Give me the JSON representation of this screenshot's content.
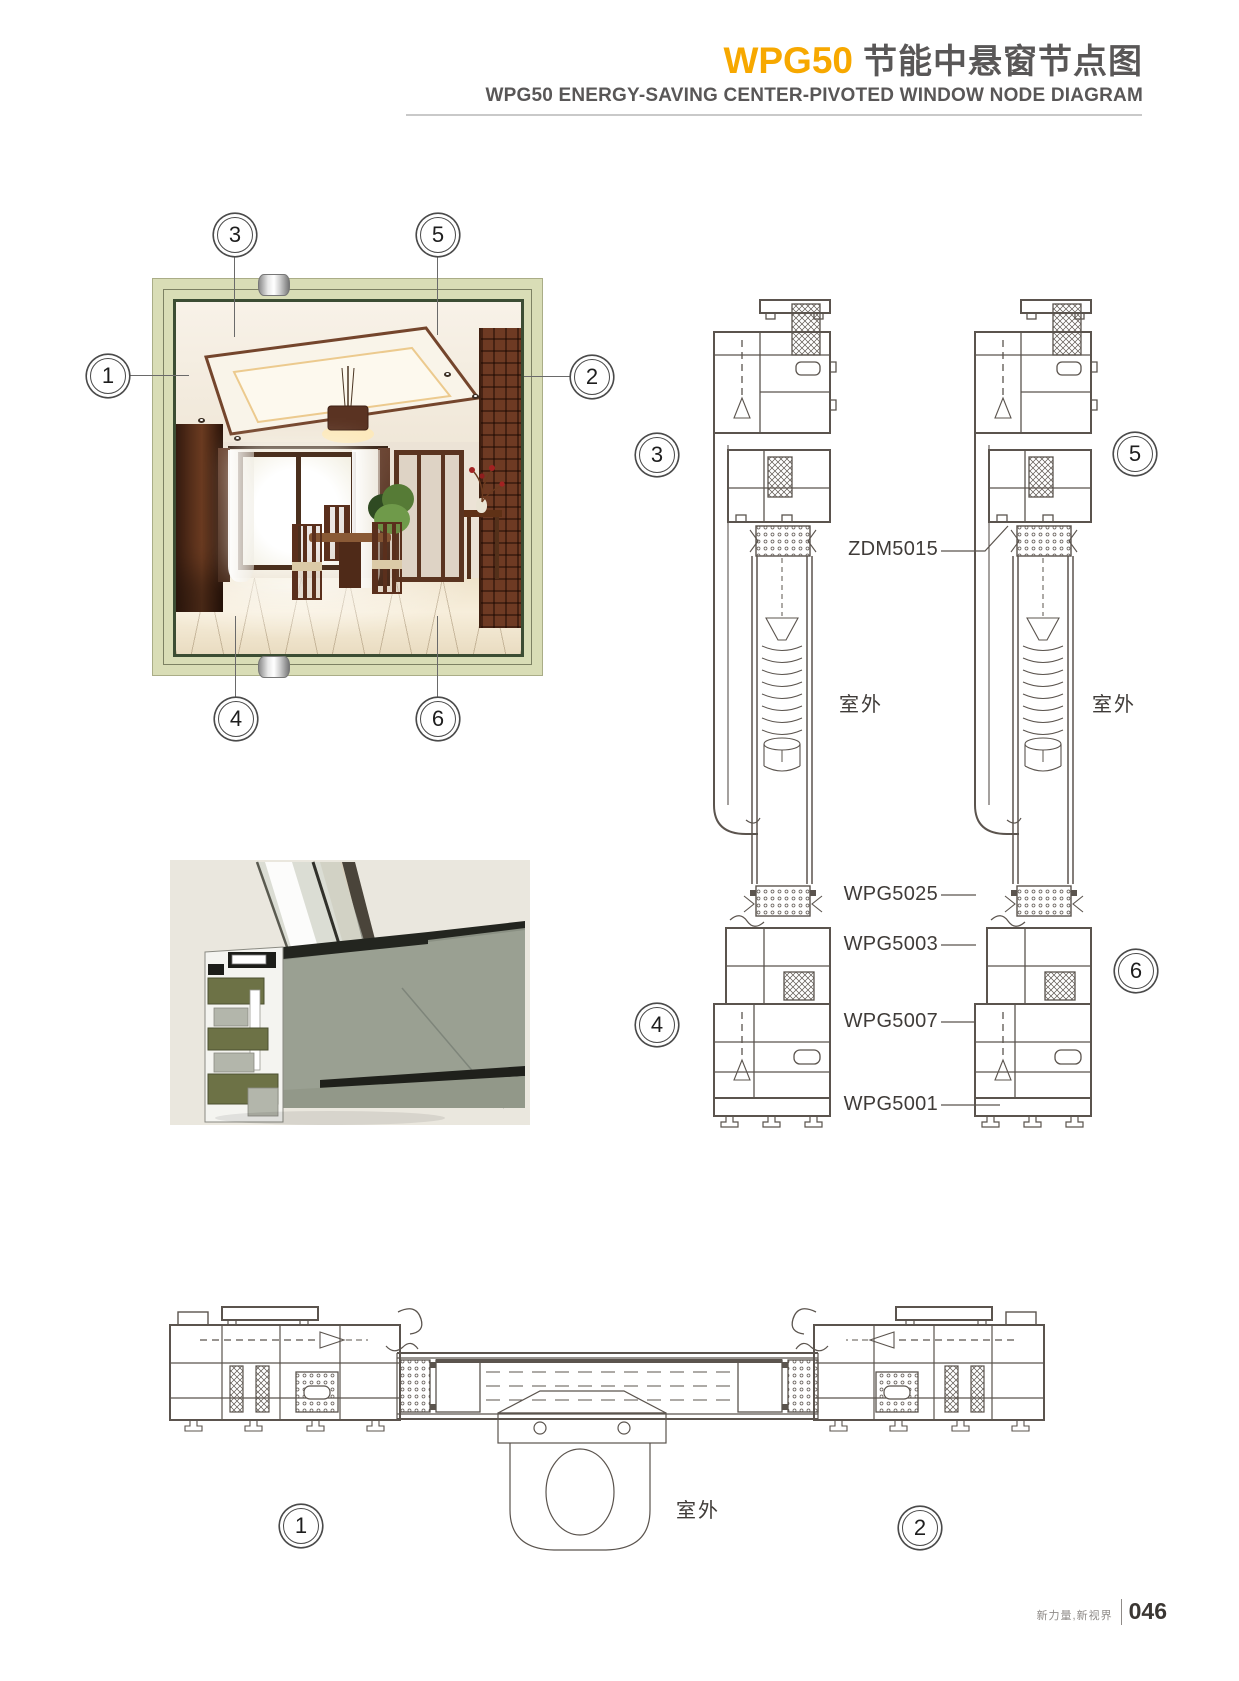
{
  "header": {
    "brand": "WPG50",
    "title_zh": "节能中悬窗节点图",
    "subtitle_en": "WPG50 ENERGY-SAVING CENTER-PIVOTED WINDOW NODE DIAGRAM"
  },
  "callouts": {
    "n1": "1",
    "n2": "2",
    "n3": "3",
    "n4": "4",
    "n5": "5",
    "n6": "6"
  },
  "diagram": {
    "outdoor_label": "室外",
    "part_labels": {
      "zdm5015": "ZDM5015",
      "wpg5025": "WPG5025",
      "wpg5003": "WPG5003",
      "wpg5007": "WPG5007",
      "wpg5001": "WPG5001"
    }
  },
  "footer": {
    "slogan": "新力量,新视界",
    "page_number": "046"
  },
  "colors": {
    "accent_orange": "#F7A800",
    "title_gray": "#595757",
    "drawing_line": "#5B544E",
    "frame_green": "#D9DDB6"
  }
}
